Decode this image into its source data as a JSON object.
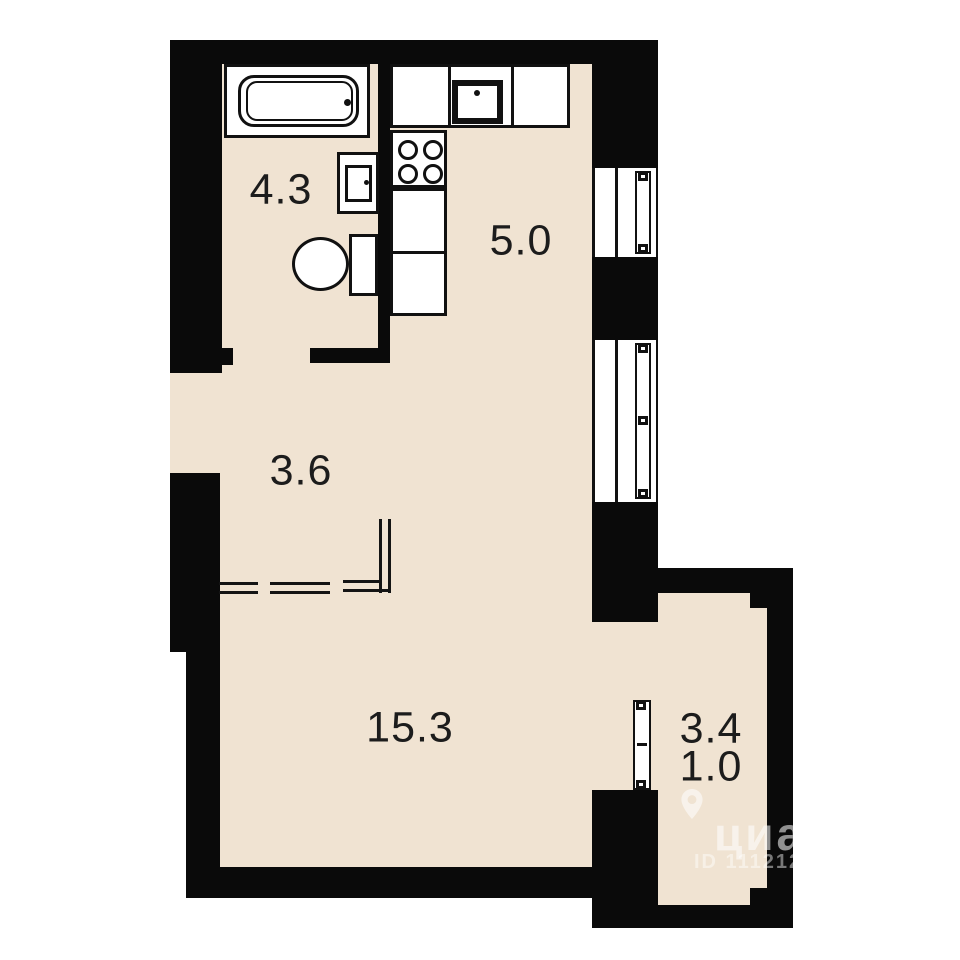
{
  "colors": {
    "wall": "#0a0a0a",
    "floor": "#f0e3d2",
    "background": "#ffffff",
    "line": "#141414",
    "label_text": "#1c1c1c"
  },
  "rooms": {
    "bathroom": {
      "area": "4.3"
    },
    "kitchen": {
      "area": "5.0"
    },
    "hallway": {
      "area": "3.6"
    },
    "living_room": {
      "area": "15.3"
    },
    "balcony": {
      "area": "3.4",
      "area_reduced": "1.0"
    }
  },
  "fixtures": [
    "bathtub",
    "washbasin",
    "toilet",
    "kitchen-sink",
    "stove",
    "counter",
    "windows",
    "balcony-door"
  ],
  "watermark": {
    "brand": "циан",
    "id_text": "ID 111212",
    "pin_icon": "location-pin-icon"
  }
}
